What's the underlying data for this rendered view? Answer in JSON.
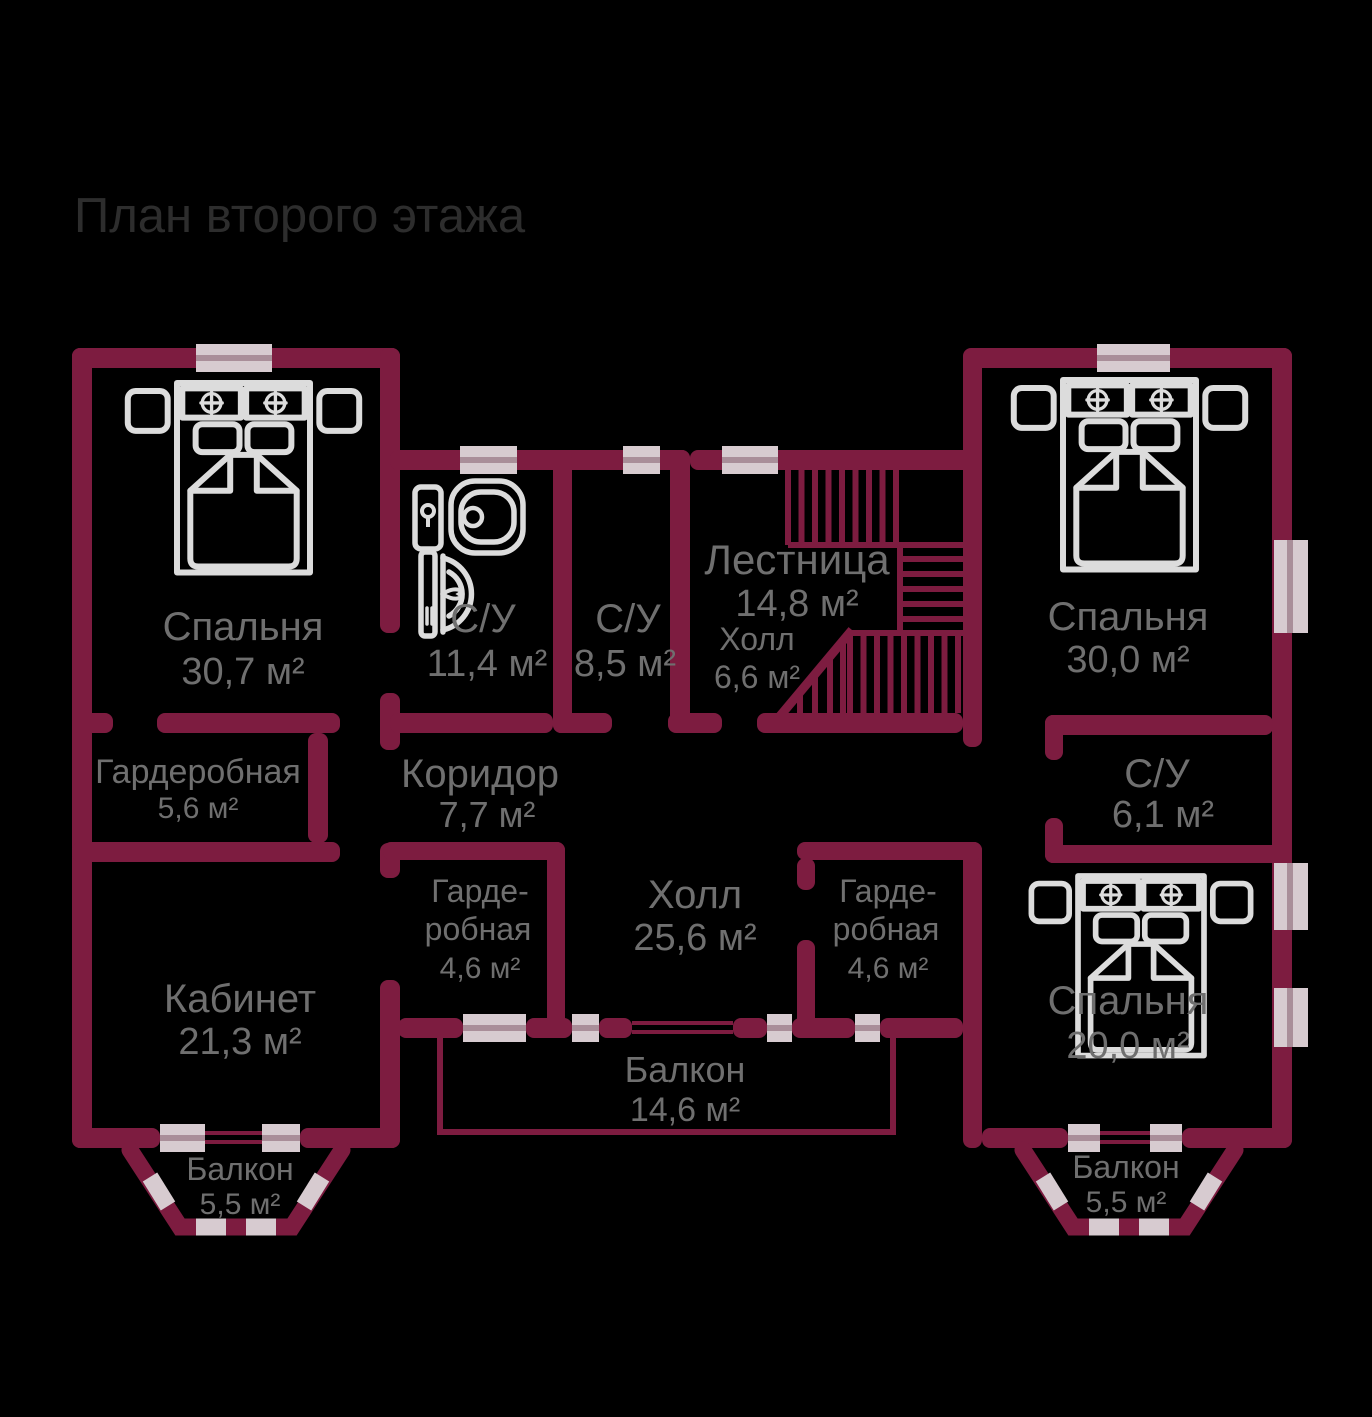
{
  "title": "План второго этажа",
  "colors": {
    "background": "#000000",
    "wall": "#7d1c40",
    "window_light": "#d7cbd0",
    "window_mid": "#a98e99",
    "furniture": "#dcdcdc",
    "label": "#6f6f6f",
    "title": "#2d2d2d"
  },
  "rooms": [
    {
      "id": "bedroom-top-left",
      "name": "Спальня",
      "area": "30,7 м²"
    },
    {
      "id": "bathroom-1",
      "name": "С/У",
      "area": "11,4 м²"
    },
    {
      "id": "bathroom-2",
      "name": "С/У",
      "area": "8,5 м²"
    },
    {
      "id": "staircase",
      "name": "Лестница",
      "area": "14,8 м²"
    },
    {
      "id": "hall-small",
      "name": "Холл",
      "area": "6,6 м²"
    },
    {
      "id": "bedroom-top-right",
      "name": "Спальня",
      "area": "30,0 м²"
    },
    {
      "id": "wardrobe-large",
      "name": "Гардеробная",
      "area": "5,6 м²"
    },
    {
      "id": "corridor",
      "name": "Коридор",
      "area": "7,7 м²"
    },
    {
      "id": "bathroom-3",
      "name": "С/У",
      "area": "6,1 м²"
    },
    {
      "id": "office",
      "name": "Кабинет",
      "area": "21,3 м²"
    },
    {
      "id": "wardrobe-left",
      "name": "Гарде-",
      "name2": "робная",
      "area": "4,6 м²"
    },
    {
      "id": "hall-large",
      "name": "Холл",
      "area": "25,6 м²"
    },
    {
      "id": "wardrobe-right",
      "name": "Гарде-",
      "name2": "робная",
      "area": "4,6 м²"
    },
    {
      "id": "bedroom-bottom-right",
      "name": "Спальня",
      "area": "20,0 м²"
    },
    {
      "id": "balcony-center",
      "name": "Балкон",
      "area": "14,6 м²"
    },
    {
      "id": "balcony-left",
      "name": "Балкон",
      "area": "5,5 м²"
    },
    {
      "id": "balcony-right",
      "name": "Балкон",
      "area": "5,5 м²"
    }
  ]
}
